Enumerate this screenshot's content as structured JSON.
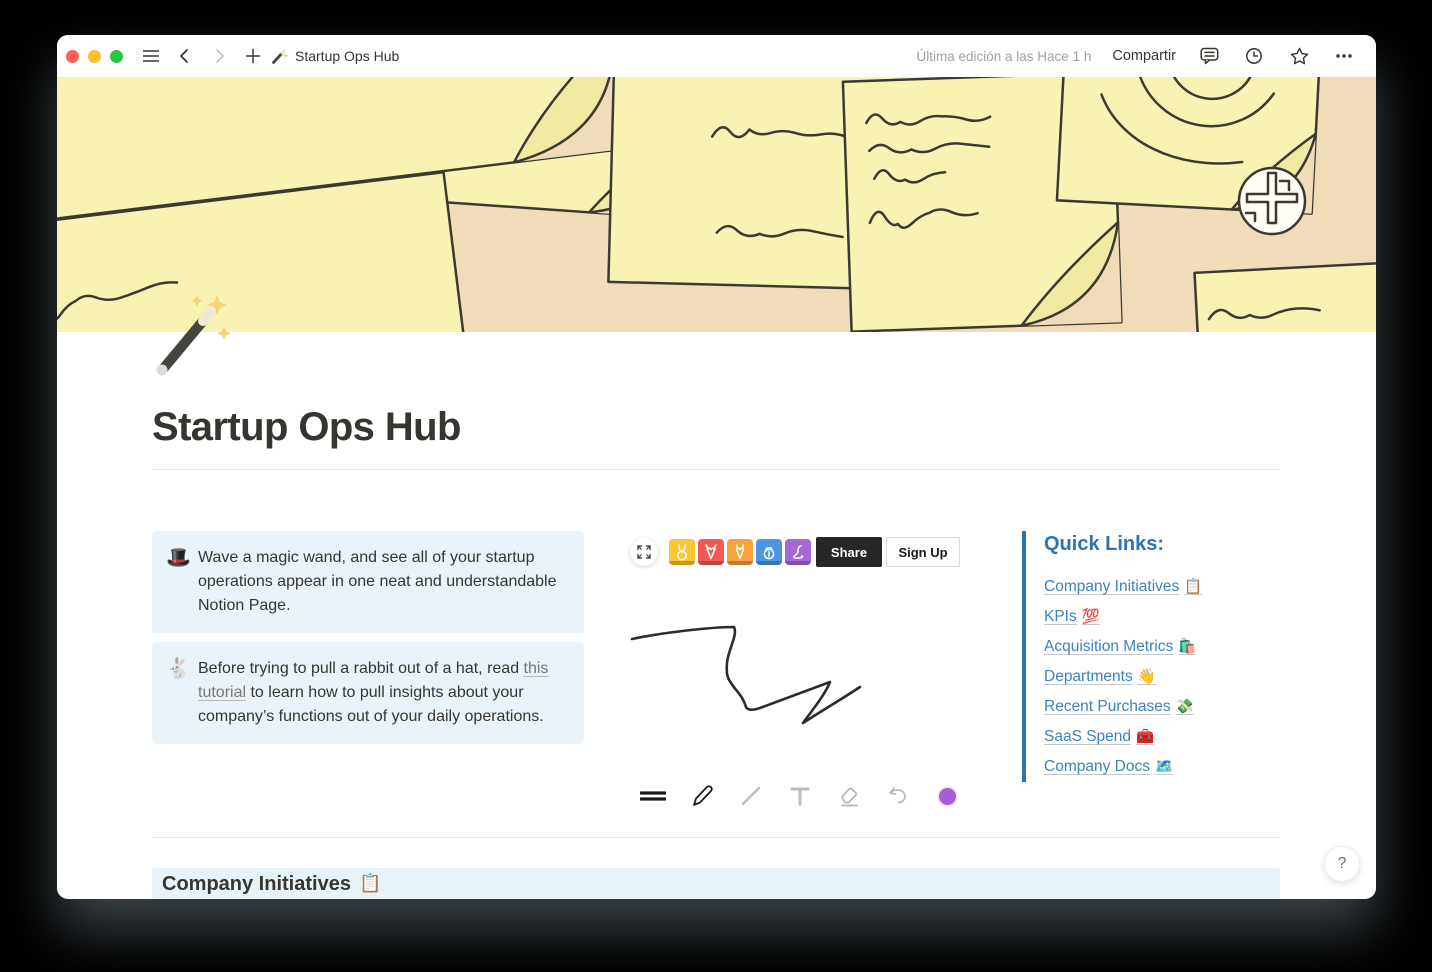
{
  "titlebar": {
    "page_icon_name": "magic-wand",
    "page_title": "Startup Ops Hub",
    "last_edited": "Última edición a las Hace 1 h",
    "share_label": "Compartir"
  },
  "page": {
    "icon_name": "magic-wand",
    "title": "Startup Ops Hub"
  },
  "callouts": [
    {
      "emoji": "🎩",
      "emoji_name": "top-hat",
      "text": "Wave a magic wand, and see all of your startup operations appear in one neat and understandable Notion Page."
    },
    {
      "emoji": "🐇",
      "emoji_name": "rabbit",
      "text_before": "Before trying to pull a rabbit out of a hat, read ",
      "link_text": "this tutorial",
      "text_after": " to learn how to pull insights about your company’s functions out of your daily operations."
    }
  ],
  "whiteboard": {
    "share_label": "Share",
    "signup_label": "Sign Up",
    "avatars": [
      {
        "name": "rabbit-avatar",
        "color": "#FDC52F"
      },
      {
        "name": "deer-avatar",
        "color": "#F05B56"
      },
      {
        "name": "giraffe-avatar",
        "color": "#F6A33B"
      },
      {
        "name": "lantern-avatar",
        "color": "#4A96E0"
      },
      {
        "name": "snake-avatar",
        "color": "#A767D6"
      }
    ],
    "tools": [
      "stroke-width",
      "pen",
      "line",
      "text",
      "eraser",
      "undo",
      "color"
    ],
    "active_color": "#A85CD6"
  },
  "quick_links": {
    "heading": "Quick Links:",
    "links": [
      {
        "label": "Company Initiatives",
        "emoji": "📋",
        "emoji_name": "clipboard"
      },
      {
        "label": "KPIs",
        "emoji": "💯",
        "emoji_name": "hundred-points"
      },
      {
        "label": "Acquisition Metrics",
        "emoji": "🛍️",
        "emoji_name": "shopping-bags"
      },
      {
        "label": "Departments",
        "emoji": "👋",
        "emoji_name": "waving-hand"
      },
      {
        "label": "Recent Purchases",
        "emoji": "💸",
        "emoji_name": "money-with-wings"
      },
      {
        "label": "SaaS Spend",
        "emoji": "🧰",
        "emoji_name": "toolbox"
      },
      {
        "label": "Company Docs",
        "emoji": "🗺️",
        "emoji_name": "world-map"
      }
    ]
  },
  "section_heading": {
    "title": "Company Initiatives",
    "emoji": "📋",
    "emoji_name": "clipboard"
  },
  "help_button": "?",
  "colors": {
    "link_blue": "#337EA9",
    "callout_bg": "#EAF3F9",
    "band_bg": "#E7F3F8",
    "cover_bg": "#F1DCBA",
    "note_yellow": "#F8F3B3",
    "traffic": [
      "#FE5F57",
      "#FEBC2F",
      "#27C93F"
    ]
  }
}
